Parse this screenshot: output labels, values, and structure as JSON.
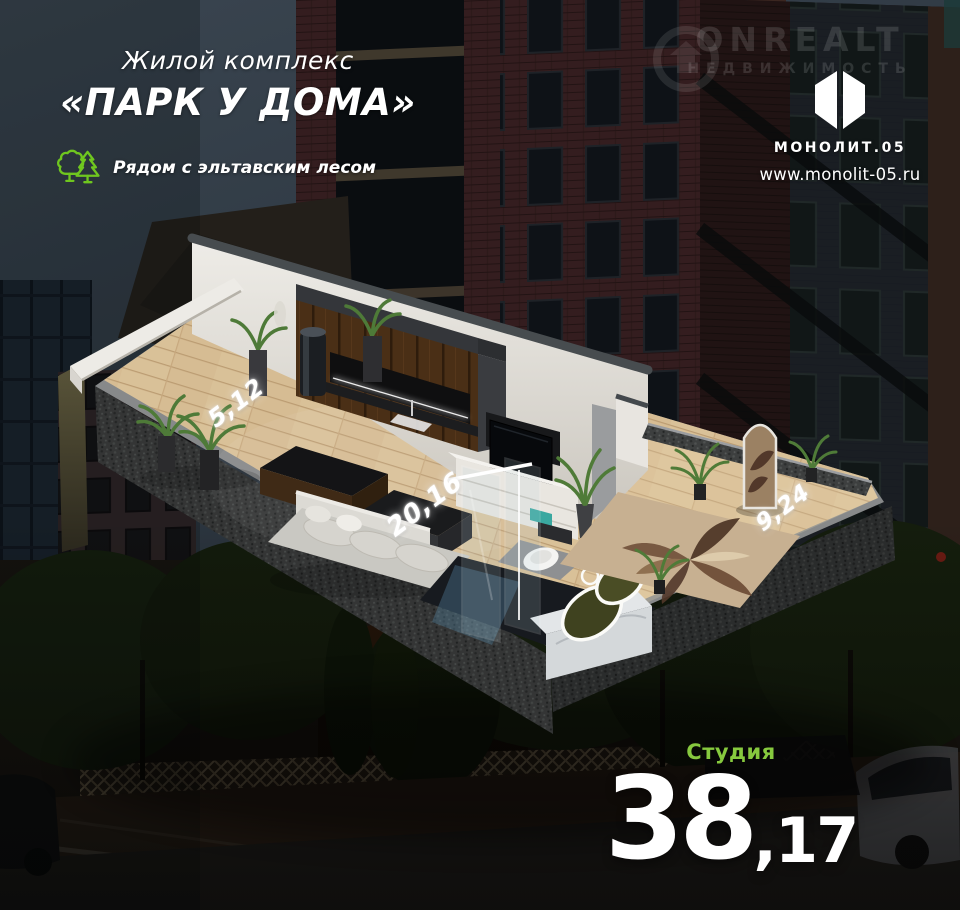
{
  "header": {
    "complex_label": "Жилой комплекс",
    "complex_name": "«ПАРК У ДОМА»",
    "eco_note": "Рядом с эльтавским лесом",
    "eco_icon": "trees-icon"
  },
  "watermark": {
    "line1": "ONREALT",
    "line2": "НЕДВИЖИМОСТЬ",
    "icon": "onrealt-circle-logo"
  },
  "brand": {
    "logo_icon": "monolit-logo",
    "name": "МОНОЛИТ.05",
    "website": "www.monolit-05.ru"
  },
  "plan": {
    "areas": [
      {
        "id": "terrace",
        "value": "5,12"
      },
      {
        "id": "living",
        "value": "20,16"
      },
      {
        "id": "balcony",
        "value": "9,24"
      }
    ],
    "unit_type": "Студия",
    "total_area": {
      "int": "38",
      "frac": ",17"
    }
  },
  "colors": {
    "accent_green_icon": "#6fc71f",
    "accent_green_text": "#86c93e",
    "text_white": "#ffffff"
  }
}
